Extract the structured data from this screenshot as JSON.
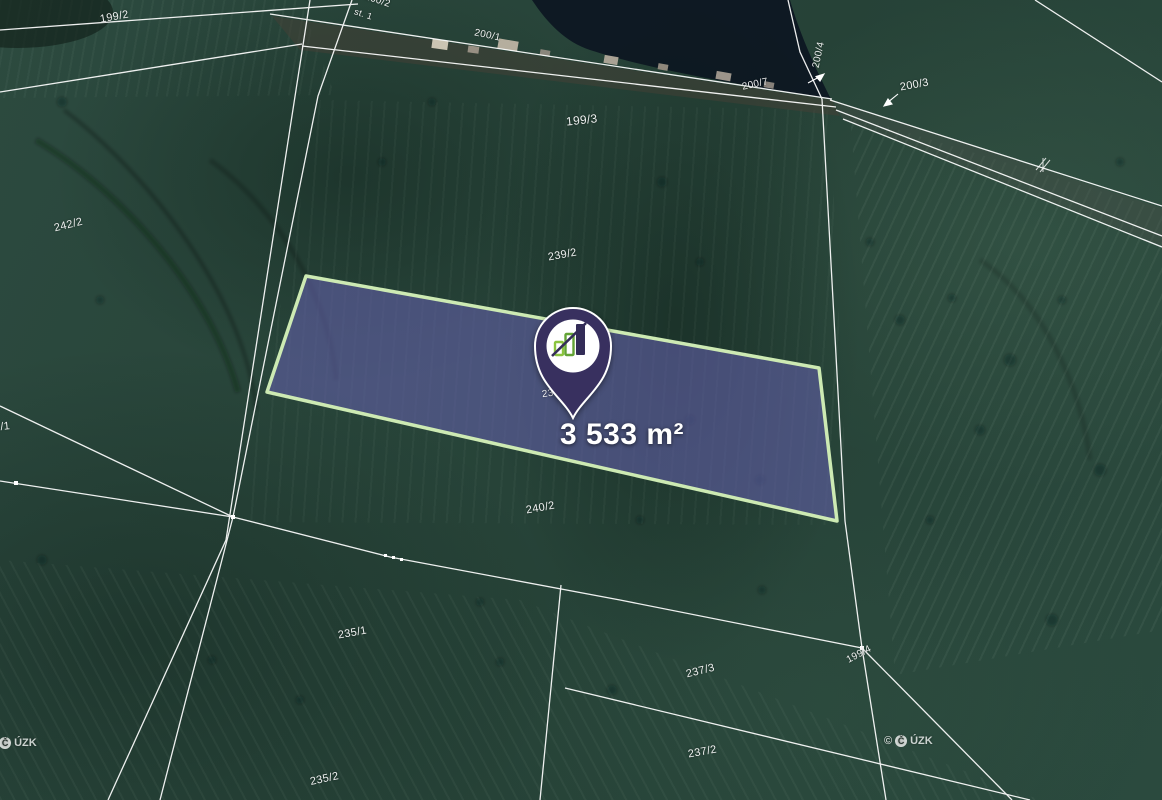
{
  "map": {
    "area_label": "3 533 m²",
    "pin_hidden_label": "239",
    "watermark": {
      "copyright": "©",
      "logo_letter": "Č",
      "agency": "ÚZK"
    }
  },
  "colors": {
    "parcel_fill": "#625fa8",
    "parcel_border": "#cdeab3",
    "pin_body": "#38305f",
    "pin_circle": "#ffffff",
    "bar_green_light": "#8bc43f",
    "bar_green_dark": "#63a335",
    "bar_navy": "#332c57",
    "line_white": "#ffffff"
  },
  "parcel_labels": [
    {
      "text": "199/2",
      "x": 100,
      "y": 12,
      "rot": -10,
      "size": 11
    },
    {
      "text": "160/2",
      "x": 364,
      "y": -4,
      "rot": 18,
      "size": 10
    },
    {
      "text": "st. 1",
      "x": 354,
      "y": 10,
      "rot": 18,
      "size": 9
    },
    {
      "text": "200/1",
      "x": 474,
      "y": 31,
      "rot": 12,
      "size": 10
    },
    {
      "text": "199/3",
      "x": 566,
      "y": 114,
      "rot": -6,
      "size": 12
    },
    {
      "text": "200/7",
      "x": 742,
      "y": 80,
      "rot": -12,
      "size": 10
    },
    {
      "text": "200/4",
      "x": 806,
      "y": 50,
      "rot": -78,
      "size": 10
    },
    {
      "text": "200/3",
      "x": 900,
      "y": 80,
      "rot": -10,
      "size": 11
    },
    {
      "text": "242/2",
      "x": 54,
      "y": 220,
      "rot": -14,
      "size": 11
    },
    {
      "text": "239/2",
      "x": 548,
      "y": 250,
      "rot": -10,
      "size": 11
    },
    {
      "text": "2/1",
      "x": -6,
      "y": 422,
      "rot": -6,
      "size": 11
    },
    {
      "text": "240/2",
      "x": 526,
      "y": 503,
      "rot": -10,
      "size": 11
    },
    {
      "text": "235/1",
      "x": 338,
      "y": 628,
      "rot": -10,
      "size": 11
    },
    {
      "text": "237/3",
      "x": 686,
      "y": 666,
      "rot": -14,
      "size": 11
    },
    {
      "text": "199/4",
      "x": 846,
      "y": 650,
      "rot": -28,
      "size": 10
    },
    {
      "text": "237/2",
      "x": 688,
      "y": 747,
      "rot": -10,
      "size": 11
    },
    {
      "text": "235/2",
      "x": 310,
      "y": 774,
      "rot": -12,
      "size": 11
    }
  ]
}
